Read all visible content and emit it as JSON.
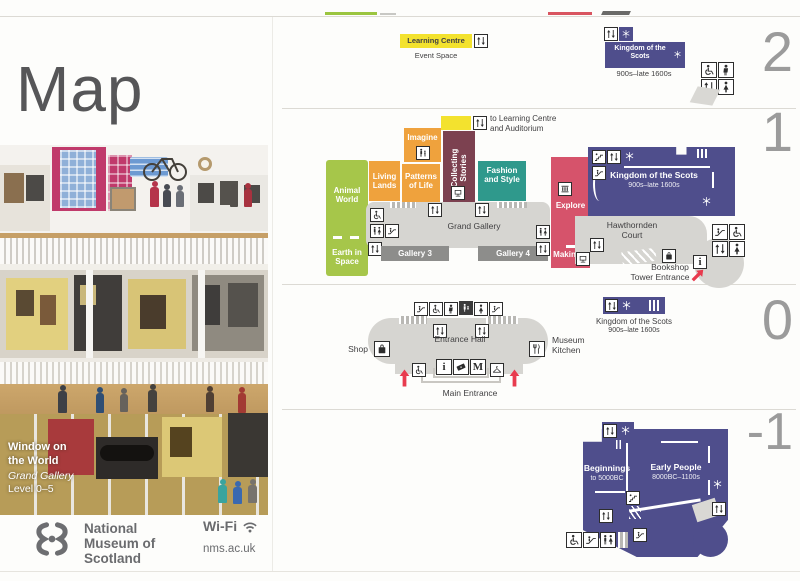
{
  "title": "Map",
  "floor2": {
    "number": "2",
    "learning_centre": "Learning Centre",
    "event_space": "Event Space",
    "kingdom": "Kingdom of the Scots",
    "kingdom_era": "900s–late 1600s"
  },
  "floor1": {
    "number": "1",
    "to_learning_1": "to Learning Centre",
    "to_learning_2": "and Auditorium",
    "imagine": "Imagine",
    "living_lands": "Living Lands",
    "patterns_of_life": "Patterns of Life",
    "collecting_stories": "Collecting Stories",
    "fashion_and_style": "Fashion and Style",
    "animal_world": "Animal World",
    "earth_in_space": "Earth in Space",
    "grand_gallery": "Grand Gallery",
    "gallery_3": "Gallery 3",
    "gallery_4": "Gallery 4",
    "explore": "Explore",
    "making_it": "Making It",
    "kingdom": "Kingdom of the Scots",
    "kingdom_era": "900s–late 1600s",
    "hawthornden_court": "Hawthornden Court",
    "bookshop": "Bookshop",
    "tower_entrance": "Tower Entrance"
  },
  "floor0": {
    "number": "0",
    "shop": "Shop",
    "entrance_hall": "Entrance Hall",
    "museum_kitchen": "Museum Kitchen",
    "main_entrance": "Main Entrance",
    "kingdom": "Kingdom of the Scots",
    "kingdom_era": "900s–late 1600s"
  },
  "floor_minus1": {
    "number": "-1",
    "beginnings": "Beginnings",
    "beginnings_era": "to 5000BC",
    "early_people": "Early People",
    "early_people_era": "8000BC–1100s"
  },
  "photo": {
    "caption_title_1": "Window on",
    "caption_title_2": "the World",
    "caption_sub": "Grand Gallery",
    "caption_level": "Level 0–5"
  },
  "brand": {
    "name_1": "National",
    "name_2": "Museum of",
    "name_3": "Scotland",
    "wifi": "Wi-Fi",
    "url": "nms.ac.uk"
  },
  "glyphs": {
    "info": "i",
    "meeting_point": "M"
  },
  "icons": {
    "lift": "up-down-arrows",
    "stairs": "steps",
    "escalator": "diagonal-steps",
    "wheelchair": "wheelchair-symbol",
    "toilets": "man-woman-figures",
    "mens_toilet": "man-figure",
    "womens_toilet": "woman-figure",
    "baby_change": "parent-and-baby",
    "info": "serif-i",
    "meeting_point": "letter-M",
    "tickets": "ticket",
    "cloakroom": "coat-hanger",
    "shop": "bag",
    "museum_kitchen": "fork-and-knife",
    "air_cooled": "snowflake",
    "family_gallery": "adult-and-child",
    "entrance_arrow": "red-arrow",
    "wifi": "wifi-arcs"
  },
  "colors": {
    "purple": "#4f4e8c",
    "orange": "#efa23d",
    "maroon": "#7c4150",
    "teal": "#2f998c",
    "green": "#a6c64a",
    "red": "#d6536b",
    "yellow": "#f3e22e",
    "arrow_red": "#e83b4e",
    "floor_gray": "#d6d5d1",
    "band_gray": "#8d8d8b",
    "number_gray": "#9b9b9b",
    "text": "#414042"
  }
}
